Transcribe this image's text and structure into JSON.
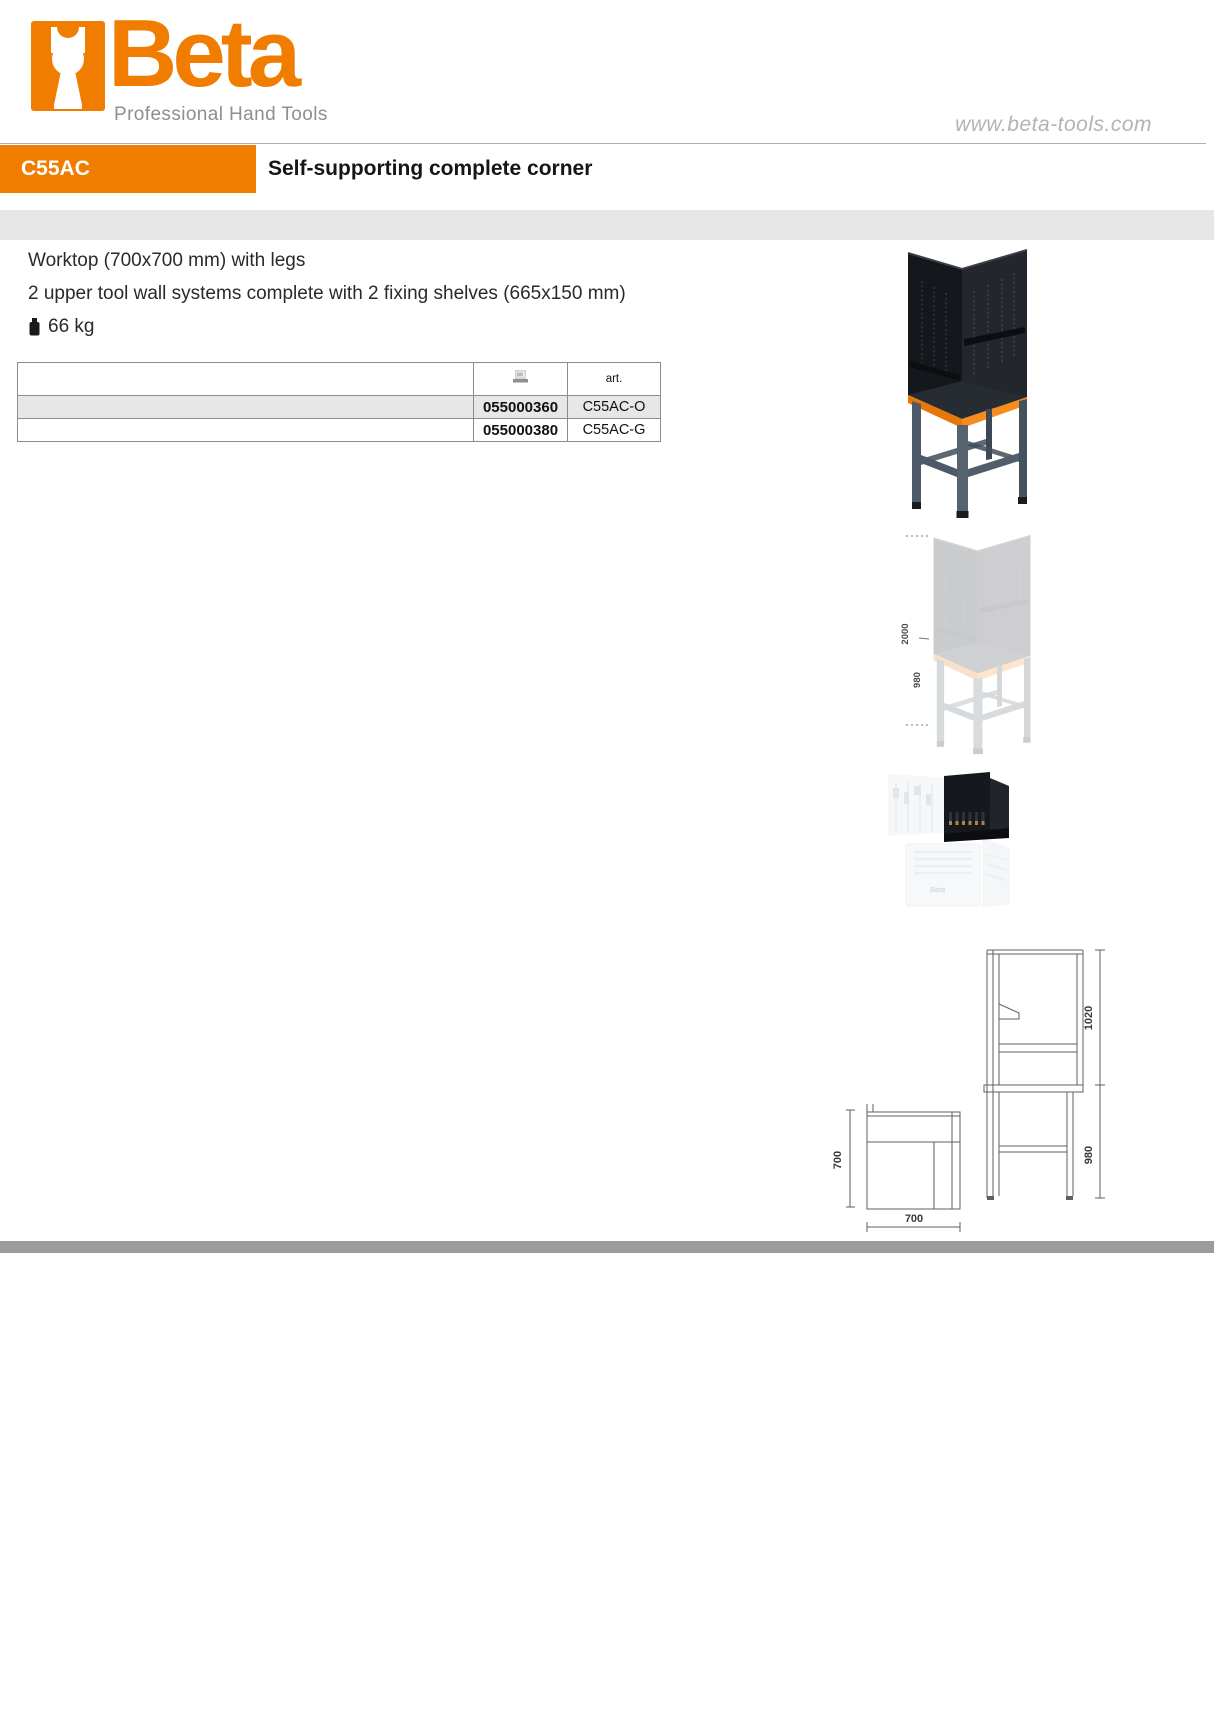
{
  "brand": {
    "name": "Beta",
    "tagline": "Professional Hand Tools",
    "website": "www.beta-tools.com"
  },
  "header": {
    "product_code": "C55AC",
    "product_title": "Self-supporting complete corner"
  },
  "description": {
    "lines": [
      "Worktop (700x700 mm) with legs",
      "2 upper tool wall systems complete with 2 fixing shelves (665x150 mm)"
    ],
    "weight": "66 kg"
  },
  "order_table": {
    "code_column_icon": "barcode-icon",
    "art_header": "art.",
    "rows": [
      {
        "code": "055000360",
        "art": "C55AC-O"
      },
      {
        "code": "055000380",
        "art": "C55AC-G"
      }
    ]
  },
  "figures": {
    "ghost_dimensions": {
      "overall_height": "2000",
      "worktop_height": "980"
    },
    "detail_logo": "Beta",
    "drawing": {
      "plan_depth": "700",
      "plan_width": "700",
      "upper_section_height": "1020",
      "bench_height": "980"
    }
  },
  "colors": {
    "brand_orange": "#f07d00",
    "band_gray": "#e7e7e7",
    "footer_gray": "#9c9c9c"
  }
}
